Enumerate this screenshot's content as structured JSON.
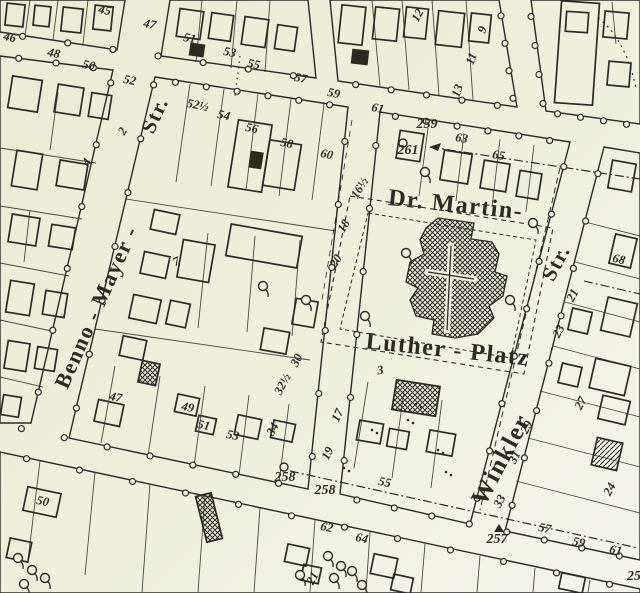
{
  "map": {
    "type": "cadastral-city-map",
    "colors": {
      "paper": "#eef0dd",
      "ink": "#2b2b24"
    },
    "street_labels": [
      {
        "text": "Benno - Mayer -",
        "x": 103,
        "y": 310,
        "rotation": -66,
        "size": 22
      },
      {
        "text": "Str.",
        "x": 161,
        "y": 118,
        "rotation": -65,
        "size": 21
      },
      {
        "text": "Dr. Martin-",
        "x": 455,
        "y": 212,
        "rotation": 6,
        "size": 24
      },
      {
        "text": "Luther - Platz",
        "x": 447,
        "y": 357,
        "rotation": 6,
        "size": 24
      },
      {
        "text": "Winkler",
        "x": 508,
        "y": 463,
        "rotation": -62,
        "size": 25
      },
      {
        "text": "Str.",
        "x": 562,
        "y": 266,
        "rotation": -62,
        "size": 21
      }
    ],
    "house_numbers": [
      {
        "n": "45",
        "x": 104,
        "y": 14,
        "r": 12
      },
      {
        "n": "47",
        "x": 149,
        "y": 28,
        "r": 12
      },
      {
        "n": "51",
        "x": 189,
        "y": 42,
        "r": 12
      },
      {
        "n": "53",
        "x": 229,
        "y": 56,
        "r": 12
      },
      {
        "n": "55",
        "x": 253,
        "y": 68,
        "r": 12
      },
      {
        "n": "57",
        "x": 300,
        "y": 82,
        "r": 12
      },
      {
        "n": "59",
        "x": 333,
        "y": 97,
        "r": 12
      },
      {
        "n": "61",
        "x": 377,
        "y": 112,
        "r": 12
      },
      {
        "n": "63",
        "x": 461,
        "y": 142,
        "r": 10
      },
      {
        "n": "65",
        "x": 498,
        "y": 159,
        "r": 10
      },
      {
        "n": "46",
        "x": 9,
        "y": 41,
        "r": 12
      },
      {
        "n": "48",
        "x": 53,
        "y": 57,
        "r": 12
      },
      {
        "n": "50",
        "x": 88,
        "y": 69,
        "r": 12
      },
      {
        "n": "52",
        "x": 129,
        "y": 84,
        "r": 12
      },
      {
        "n": "52½",
        "x": 197,
        "y": 109,
        "r": 12
      },
      {
        "n": "54",
        "x": 223,
        "y": 119,
        "r": 12
      },
      {
        "n": "56",
        "x": 251,
        "y": 132,
        "r": 12
      },
      {
        "n": "58",
        "x": 286,
        "y": 147,
        "r": 12
      },
      {
        "n": "60",
        "x": 326,
        "y": 158,
        "r": 12
      },
      {
        "n": "16½",
        "x": 363,
        "y": 190,
        "r": -58
      },
      {
        "n": "18",
        "x": 347,
        "y": 228,
        "r": -58
      },
      {
        "n": "20",
        "x": 339,
        "y": 263,
        "r": -58
      },
      {
        "n": "30",
        "x": 300,
        "y": 362,
        "r": -62
      },
      {
        "n": "32½",
        "x": 286,
        "y": 386,
        "r": -62
      },
      {
        "n": "34",
        "x": 276,
        "y": 431,
        "r": -62
      },
      {
        "n": "17",
        "x": 341,
        "y": 417,
        "r": -64
      },
      {
        "n": "19",
        "x": 331,
        "y": 455,
        "r": -64
      },
      {
        "n": "3",
        "x": 381,
        "y": 374,
        "r": -10
      },
      {
        "n": "12",
        "x": 421,
        "y": 17,
        "r": -62
      },
      {
        "n": "9",
        "x": 486,
        "y": 31,
        "r": -70
      },
      {
        "n": "11",
        "x": 475,
        "y": 60,
        "r": -70
      },
      {
        "n": "13",
        "x": 461,
        "y": 92,
        "r": -70
      },
      {
        "n": "2",
        "x": 126,
        "y": 133,
        "r": -60
      },
      {
        "n": "4",
        "x": 90,
        "y": 164,
        "r": -60
      },
      {
        "n": "7",
        "x": 178,
        "y": 265,
        "r": -25
      },
      {
        "n": "68",
        "x": 618,
        "y": 263,
        "r": 14
      },
      {
        "n": "21",
        "x": 576,
        "y": 297,
        "r": -62
      },
      {
        "n": "23",
        "x": 562,
        "y": 333,
        "r": -62
      },
      {
        "n": "27",
        "x": 584,
        "y": 405,
        "r": -62
      },
      {
        "n": "29",
        "x": 530,
        "y": 429,
        "r": -62
      },
      {
        "n": "31",
        "x": 518,
        "y": 459,
        "r": -62
      },
      {
        "n": "33",
        "x": 503,
        "y": 503,
        "r": -62
      },
      {
        "n": "24",
        "x": 613,
        "y": 491,
        "r": -62
      },
      {
        "n": "47",
        "x": 115,
        "y": 401,
        "r": 12
      },
      {
        "n": "49",
        "x": 187,
        "y": 411,
        "r": 12
      },
      {
        "n": "51",
        "x": 203,
        "y": 429,
        "r": 12
      },
      {
        "n": "53",
        "x": 232,
        "y": 439,
        "r": 12
      },
      {
        "n": "55",
        "x": 384,
        "y": 486,
        "r": 12
      },
      {
        "n": "57",
        "x": 544,
        "y": 532,
        "r": 12
      },
      {
        "n": "59",
        "x": 578,
        "y": 546,
        "r": 12
      },
      {
        "n": "61",
        "x": 615,
        "y": 554,
        "r": 12
      },
      {
        "n": "50",
        "x": 42,
        "y": 505,
        "r": 12
      },
      {
        "n": "62",
        "x": 326,
        "y": 531,
        "r": 12
      },
      {
        "n": "64",
        "x": 361,
        "y": 542,
        "r": 12
      },
      {
        "n": "21",
        "x": 316,
        "y": 580,
        "r": -62
      }
    ],
    "benchmarks": [
      {
        "n": "259",
        "x": 427,
        "y": 128,
        "symbol": "circle",
        "sx": 403,
        "sy": 143
      },
      {
        "n": "261",
        "x": 408,
        "y": 154,
        "symbol": "arrow",
        "sx": 429,
        "sy": 147
      },
      {
        "n": "258",
        "x": 285,
        "y": 481,
        "symbol": "circle",
        "sx": 284,
        "sy": 467
      },
      {
        "n": "258",
        "x": 325,
        "y": 494,
        "symbol": "none",
        "sx": 0,
        "sy": 0
      },
      {
        "n": "257",
        "x": 497,
        "y": 543,
        "symbol": "triangle",
        "sx": 499,
        "sy": 529
      },
      {
        "n": "25",
        "x": 634,
        "y": 580,
        "symbol": "none",
        "sx": 0,
        "sy": 0
      }
    ],
    "symbols": {
      "trees": [
        [
          263,
          286
        ],
        [
          306,
          300
        ],
        [
          425,
          172
        ],
        [
          533,
          223
        ],
        [
          406,
          253
        ],
        [
          510,
          300
        ],
        [
          365,
          316
        ],
        [
          328,
          556
        ],
        [
          341,
          566
        ],
        [
          334,
          578
        ],
        [
          352,
          571
        ],
        [
          362,
          585
        ],
        [
          300,
          575
        ],
        [
          18,
          558
        ],
        [
          32,
          570
        ],
        [
          24,
          584
        ],
        [
          45,
          578
        ]
      ],
      "dot_pairs": [
        [
          408,
          420
        ],
        [
          438,
          450
        ],
        [
          372,
          430
        ],
        [
          344,
          468
        ],
        [
          446,
          472
        ],
        [
          416,
          404
        ]
      ]
    }
  }
}
